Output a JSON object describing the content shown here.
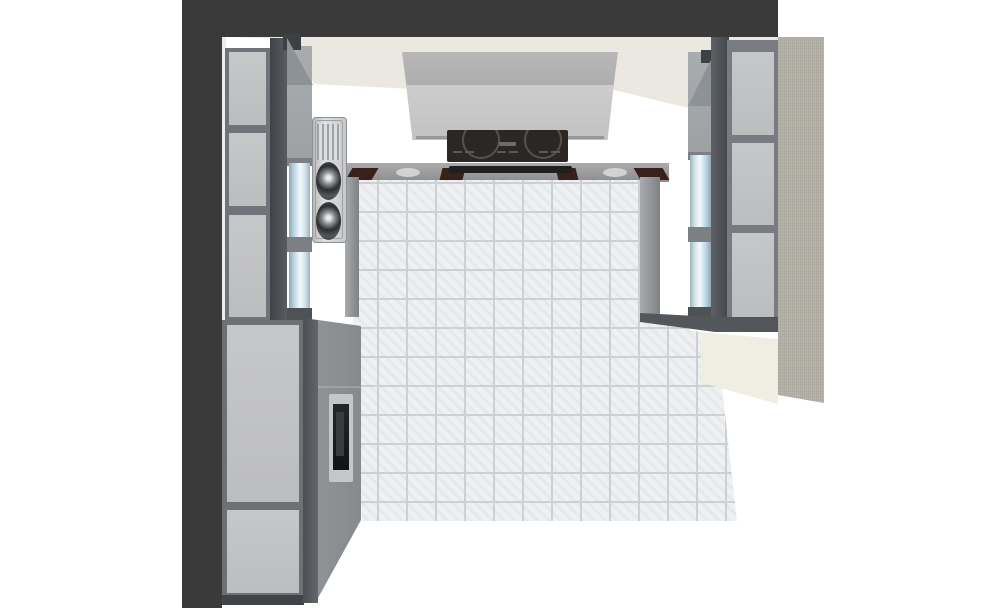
{
  "scene": {
    "type": "3d-kitchen-render",
    "room": {
      "outer_wall_color": "#3a3a3a",
      "ceiling_color": "#eae8e0",
      "back_wall_color": "#ffffff",
      "floor_tile_color": "#eef0f2",
      "floor_grout_color": "#ccd0d4",
      "right_end_panel_color": "#b4b1a6",
      "right_lower_wall_color": "#f0eee3"
    },
    "objects": {
      "left_tall_cabinet": {
        "panel_color": "#c6c7c9",
        "frame_color": "#6d7176",
        "upper_panels": 3,
        "lower_panels": 2
      },
      "left_glass_cabinet": {
        "glass_color": "#cfe2ee",
        "doors": 2
      },
      "sink_unit": {
        "material_color": "#d7d8d9",
        "bowls": 2,
        "has_drainboard": true
      },
      "oven_tower": {
        "body_color": "#8e9295",
        "door_color": "#1c1c1e"
      },
      "range_hood": {
        "chimney_color": "#b4b4b4",
        "canopy_color": "#c9c9ca"
      },
      "induction_hob": {
        "surface_color": "#2a2725",
        "burners": 2
      },
      "back_counter": {
        "top_color": "#9c9c9e",
        "wood_accent_color": "#38211a",
        "wood_accents": 4
      },
      "right_glass_cabinet": {
        "glass_color": "#cfe2ee",
        "doors": 2
      },
      "right_tall_cabinet": {
        "panel_color": "#c7c8ca",
        "frame_color": "#787c80",
        "panels": 3
      }
    }
  }
}
